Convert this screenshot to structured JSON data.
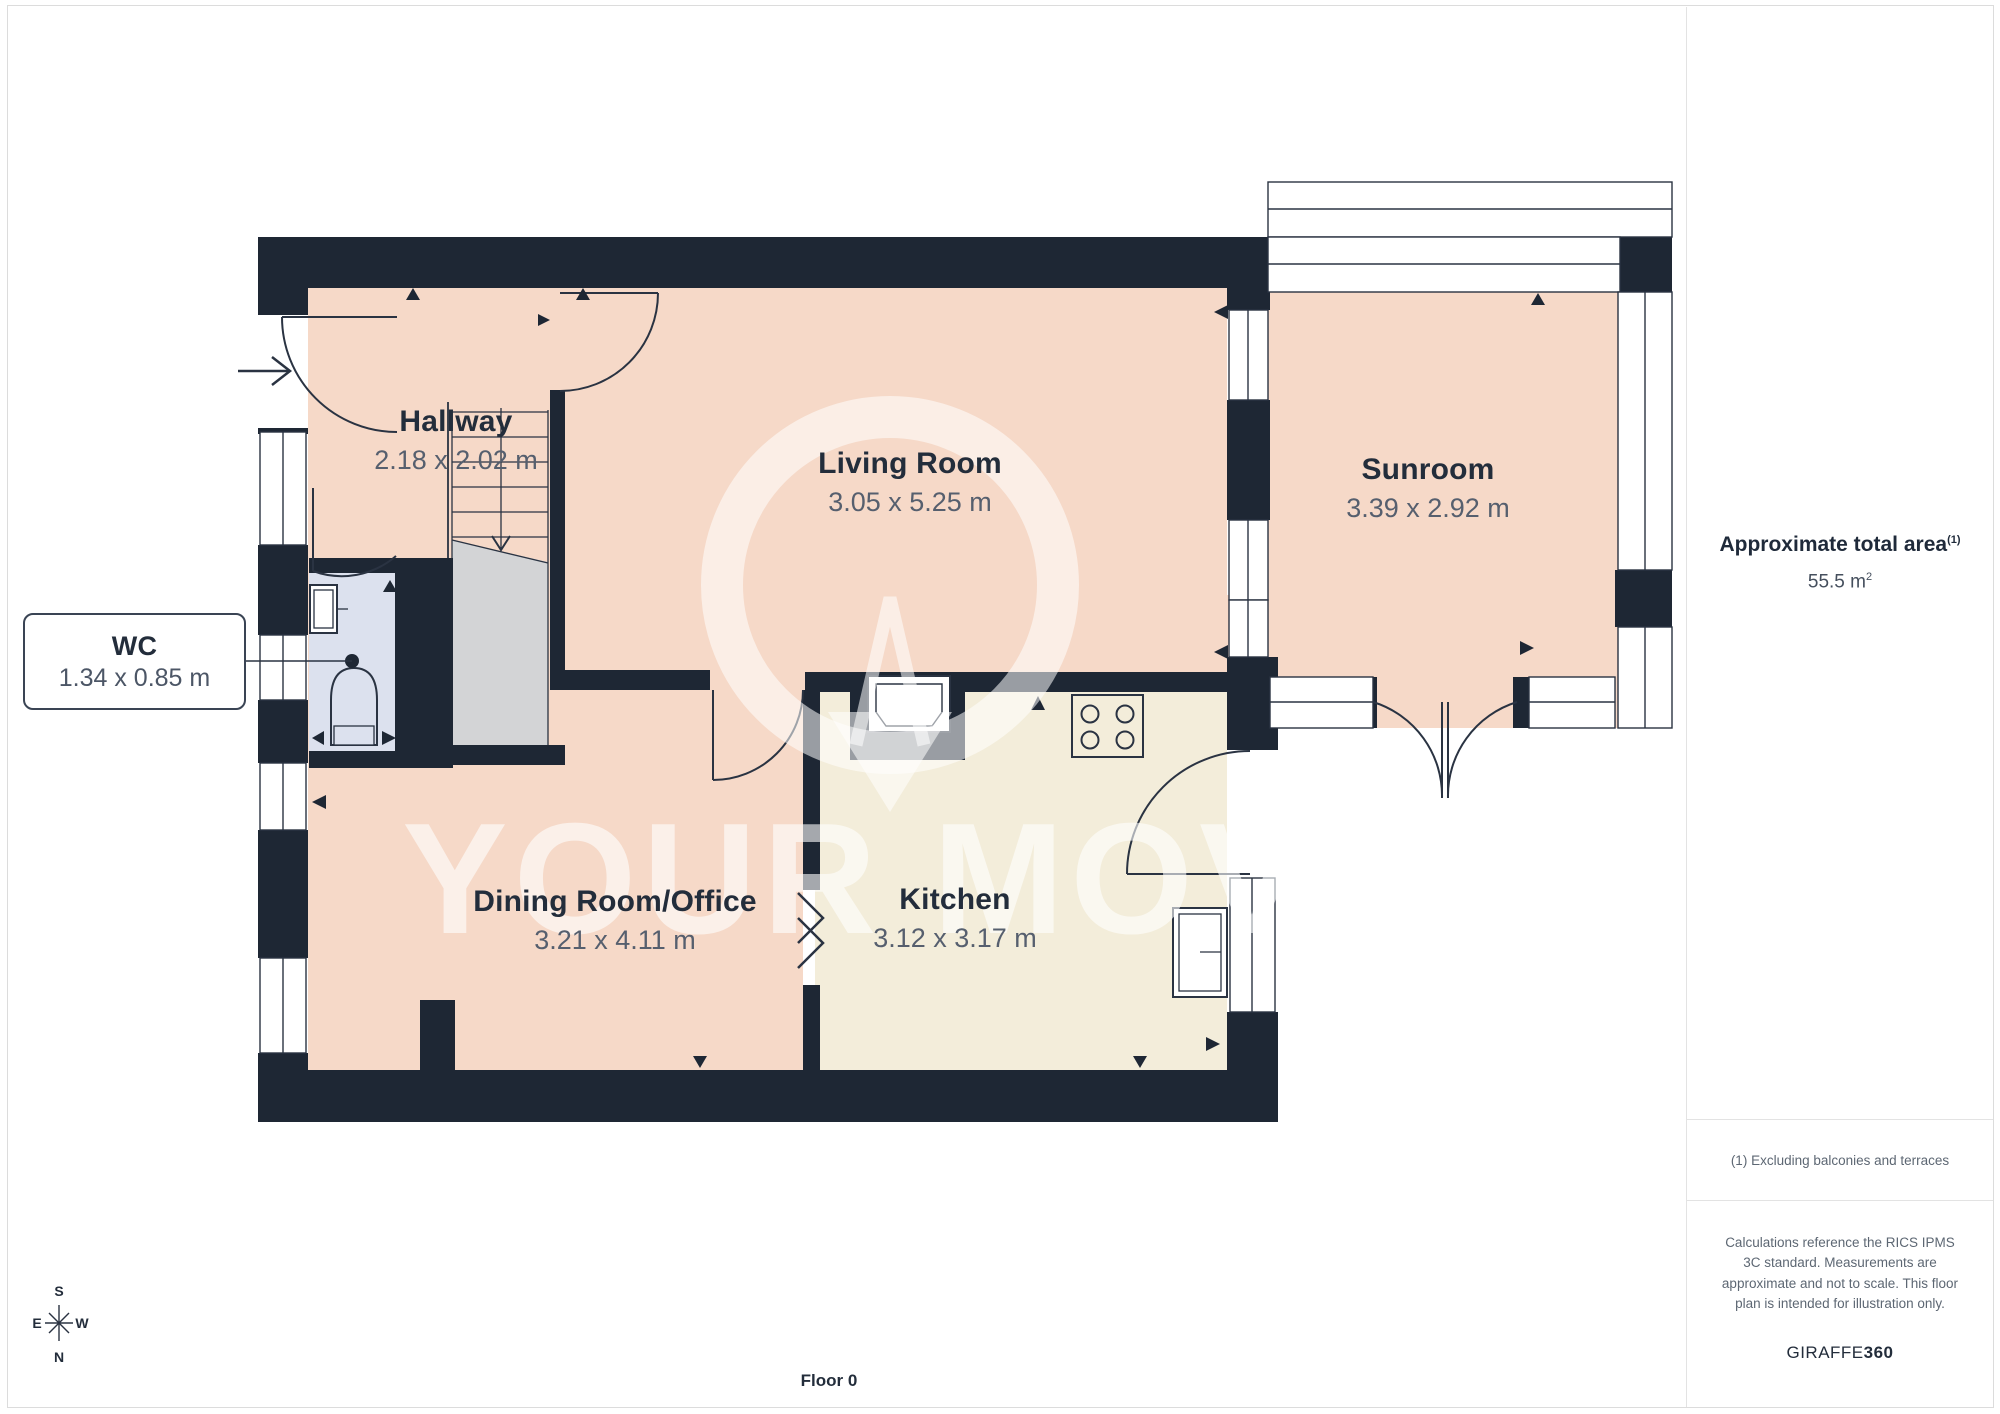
{
  "floorplan": {
    "floor_label": "Floor 0",
    "watermark": "YOUR MOVE",
    "rooms": [
      {
        "id": "hallway",
        "name": "Hallway",
        "dims": "2.18 x 2.02 m"
      },
      {
        "id": "living",
        "name": "Living Room",
        "dims": "3.05 x 5.25 m"
      },
      {
        "id": "sunroom",
        "name": "Sunroom",
        "dims": "3.39 x 2.92 m"
      },
      {
        "id": "wc",
        "name": "WC",
        "dims": "1.34 x 0.85 m"
      },
      {
        "id": "dining",
        "name": "Dining Room/Office",
        "dims": "3.21 x 4.11 m"
      },
      {
        "id": "kitchen",
        "name": "Kitchen",
        "dims": "3.12 x 3.17 m"
      }
    ],
    "compass": {
      "n": "N",
      "s": "S",
      "e": "E",
      "w": "W"
    }
  },
  "sidebar": {
    "area_title": "Approximate total area",
    "area_superscript": "(1)",
    "area_value": "55.5 m",
    "area_value_sup": "2",
    "footnote": "(1) Excluding balconies and terraces",
    "disclaimer": "Calculations reference the RICS IPMS 3C standard. Measurements are approximate and not to scale. This floor plan is intended for illustration only.",
    "brand": "GIRAFFE",
    "brand_bold": "360"
  },
  "colors": {
    "wall": "#1e2734",
    "floor_pink": "#f6d9c8",
    "floor_cream": "#f3edda",
    "floor_wc": "#dce1ee",
    "stairs": "#d3d4d6",
    "outline": "#2a3342"
  }
}
